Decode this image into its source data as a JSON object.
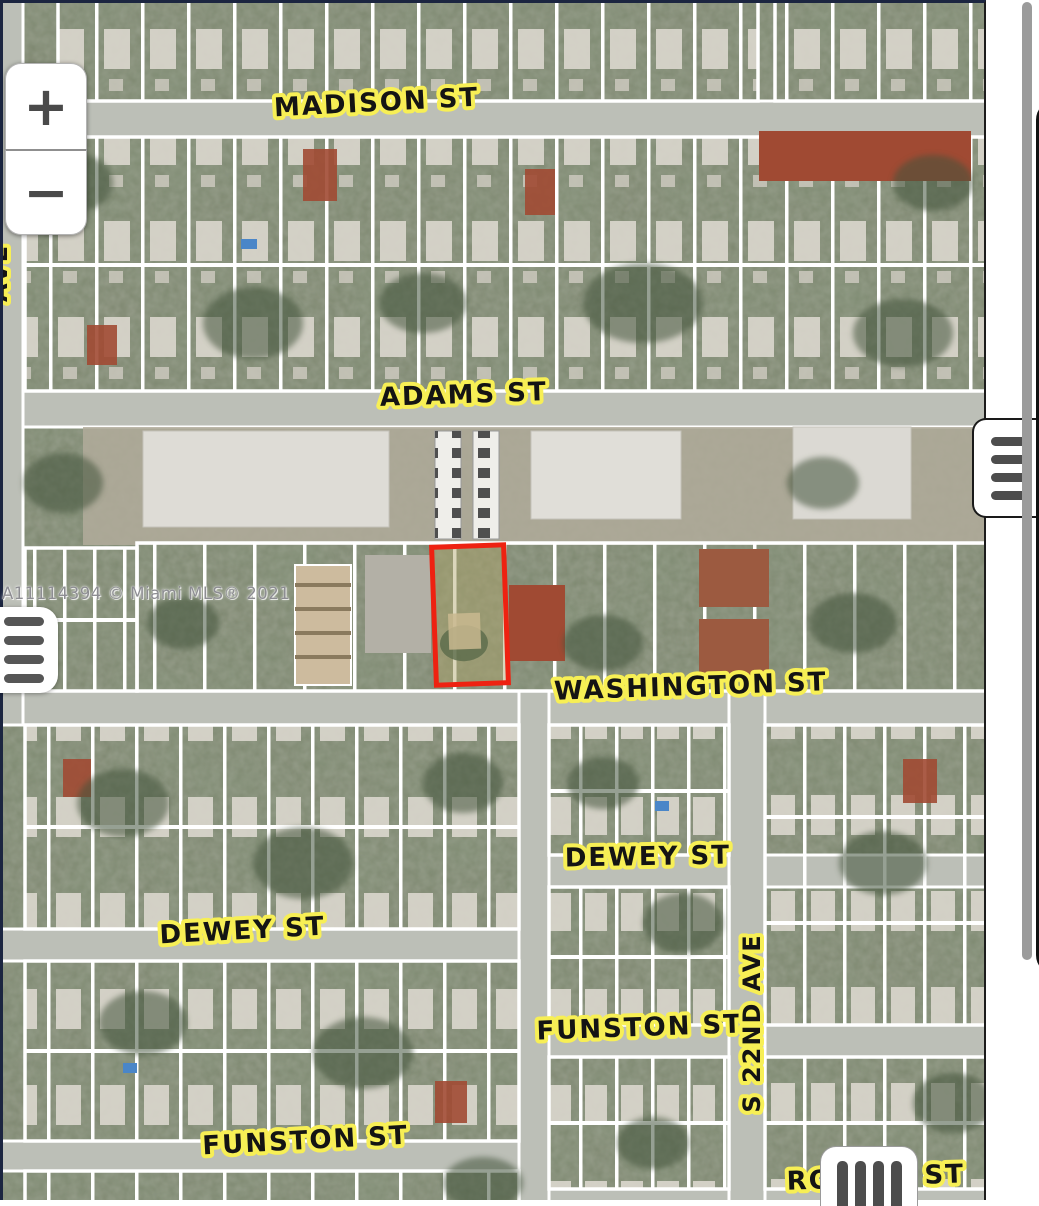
{
  "map": {
    "watermark": "A11114394 © Miami MLS® 2021",
    "subject_parcel": {
      "outline_color": "#ee2211"
    },
    "label_style": {
      "text_color": "#141414",
      "highlight_color": "#f7ef55"
    },
    "street_labels": [
      {
        "id": "madison",
        "text": "MADISON ST"
      },
      {
        "id": "adams",
        "text": "ADAMS ST"
      },
      {
        "id": "washington",
        "text": "WASHINGTON ST"
      },
      {
        "id": "dewey-east",
        "text": "DEWEY ST"
      },
      {
        "id": "dewey-west",
        "text": "DEWEY ST"
      },
      {
        "id": "funston-east",
        "text": "FUNSTON ST"
      },
      {
        "id": "funston-west",
        "text": "FUNSTON ST"
      },
      {
        "id": "s-22nd-ave",
        "text": "S 22ND AVE"
      },
      {
        "id": "bottom-street-left-part",
        "text": "RO"
      },
      {
        "id": "bottom-street-right-part",
        "text": "ST"
      },
      {
        "id": "left-edge-partial",
        "text": "AVE"
      }
    ]
  },
  "controls": {
    "zoom_in_label": "+",
    "zoom_out_label": "−"
  }
}
